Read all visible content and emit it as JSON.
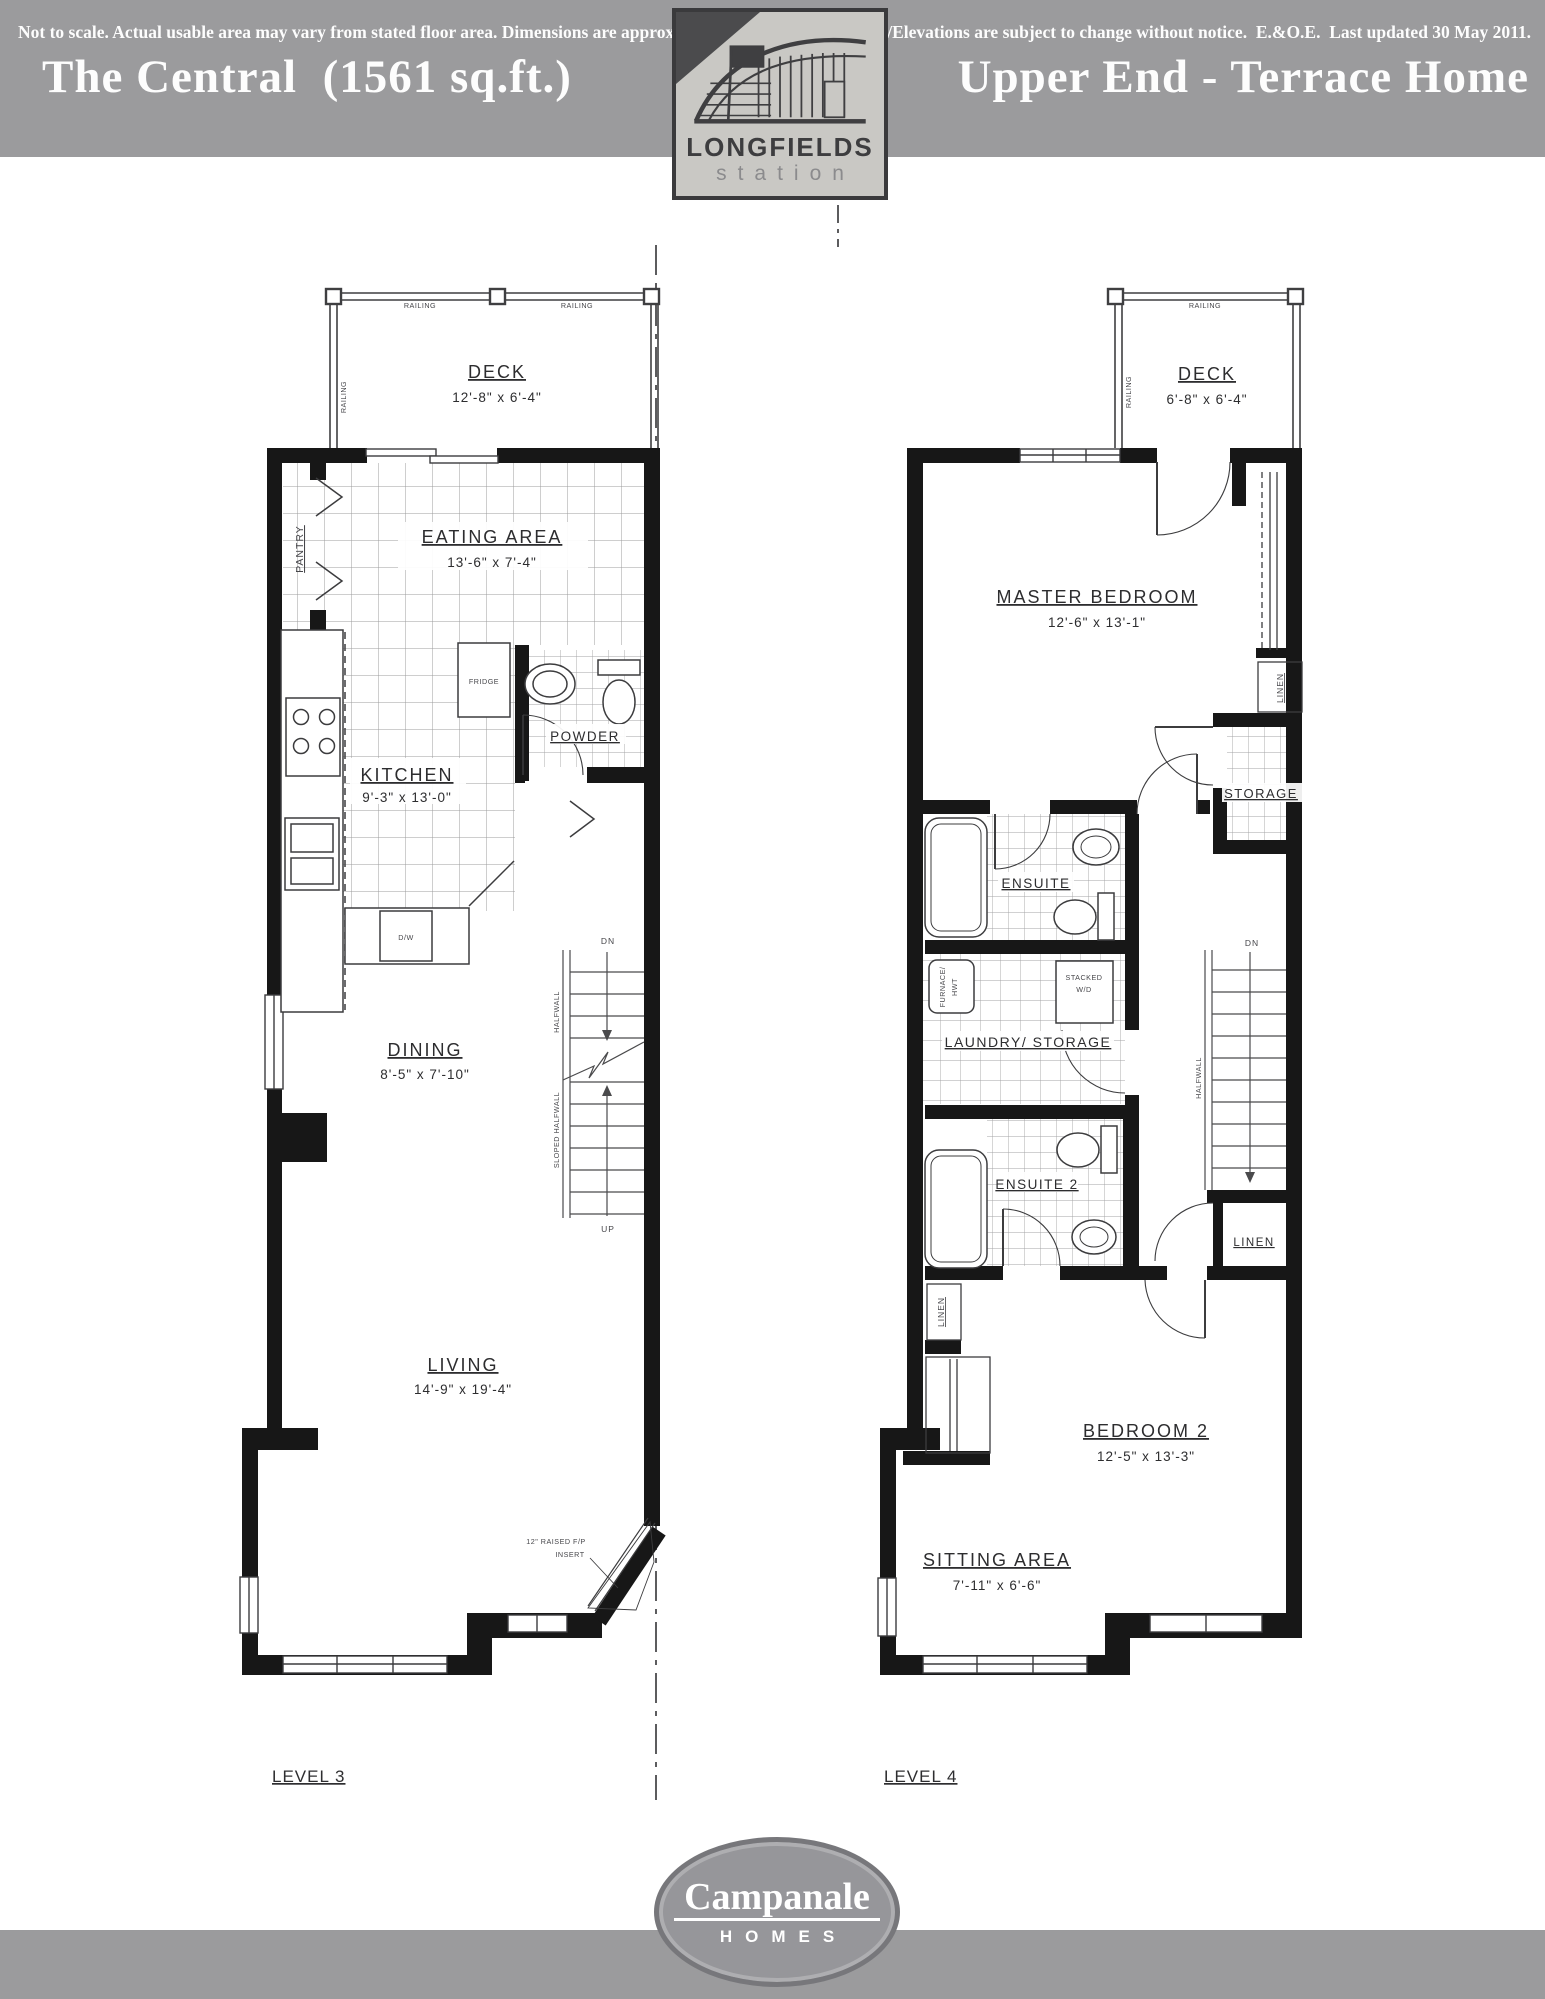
{
  "header": {
    "left_title": "The Central  (1561 sq.ft.)",
    "right_title": "Upper End - Terrace Home",
    "logo_name": "LONGFIELDS",
    "logo_sub": "station"
  },
  "level3": {
    "title": "LEVEL 3",
    "railing": "RAILING",
    "deck_name": "DECK",
    "deck_dims": "12'-8\" x 6'-4\"",
    "eating_name": "EATING AREA",
    "eating_dims": "13'-6\" x 7'-4\"",
    "pantry": "PANTRY",
    "fridge": "FRIDGE",
    "powder": "POWDER",
    "kitchen_name": "KITCHEN",
    "kitchen_dims": "9'-3\" x 13'-0\"",
    "dw": "D/W",
    "dining_name": "DINING",
    "dining_dims": "8'-5\" x 7'-10\"",
    "living_name": "LIVING",
    "living_dims": "14'-9\" x 19'-4\"",
    "halfwall": "HALFWALL",
    "sloped_halfwall": "SLOPED HALFWALL",
    "dn": "DN",
    "up": "UP",
    "fp_line1": "12\" RAISED F/P",
    "fp_line2": "INSERT"
  },
  "level4": {
    "title": "LEVEL 4",
    "railing": "RAILING",
    "deck_name": "DECK",
    "deck_dims": "6'-8\" x 6'-4\"",
    "master_name": "MASTER BEDROOM",
    "master_dims": "12'-6\" x 13'-1\"",
    "linen": "LINEN",
    "storage": "STORAGE",
    "ensuite": "ENSUITE",
    "laundry": "LAUNDRY/ STORAGE",
    "stacked_line1": "STACKED",
    "stacked_line2": "W/D",
    "furnace_line1": "FURNACE/",
    "furnace_line2": "HWT",
    "ensuite2": "ENSUITE 2",
    "bedroom2_name": "BEDROOM 2",
    "bedroom2_dims": "12'-5\" x 13'-3\"",
    "sitting_name": "SITTING AREA",
    "sitting_dims": "7'-11\" x 6'-6\"",
    "halfwall": "HALFWALL",
    "dn": "DN"
  },
  "footer": {
    "brand_name": "Campanale",
    "brand_sub": "HOMES",
    "left_note": "Not to scale. Actual usable area may vary from stated floor area. Dimensions are approximate.",
    "right_note": "Plans/Elevations are subject to change without notice.  E.&O.E.  Last updated 30 May 2011."
  }
}
